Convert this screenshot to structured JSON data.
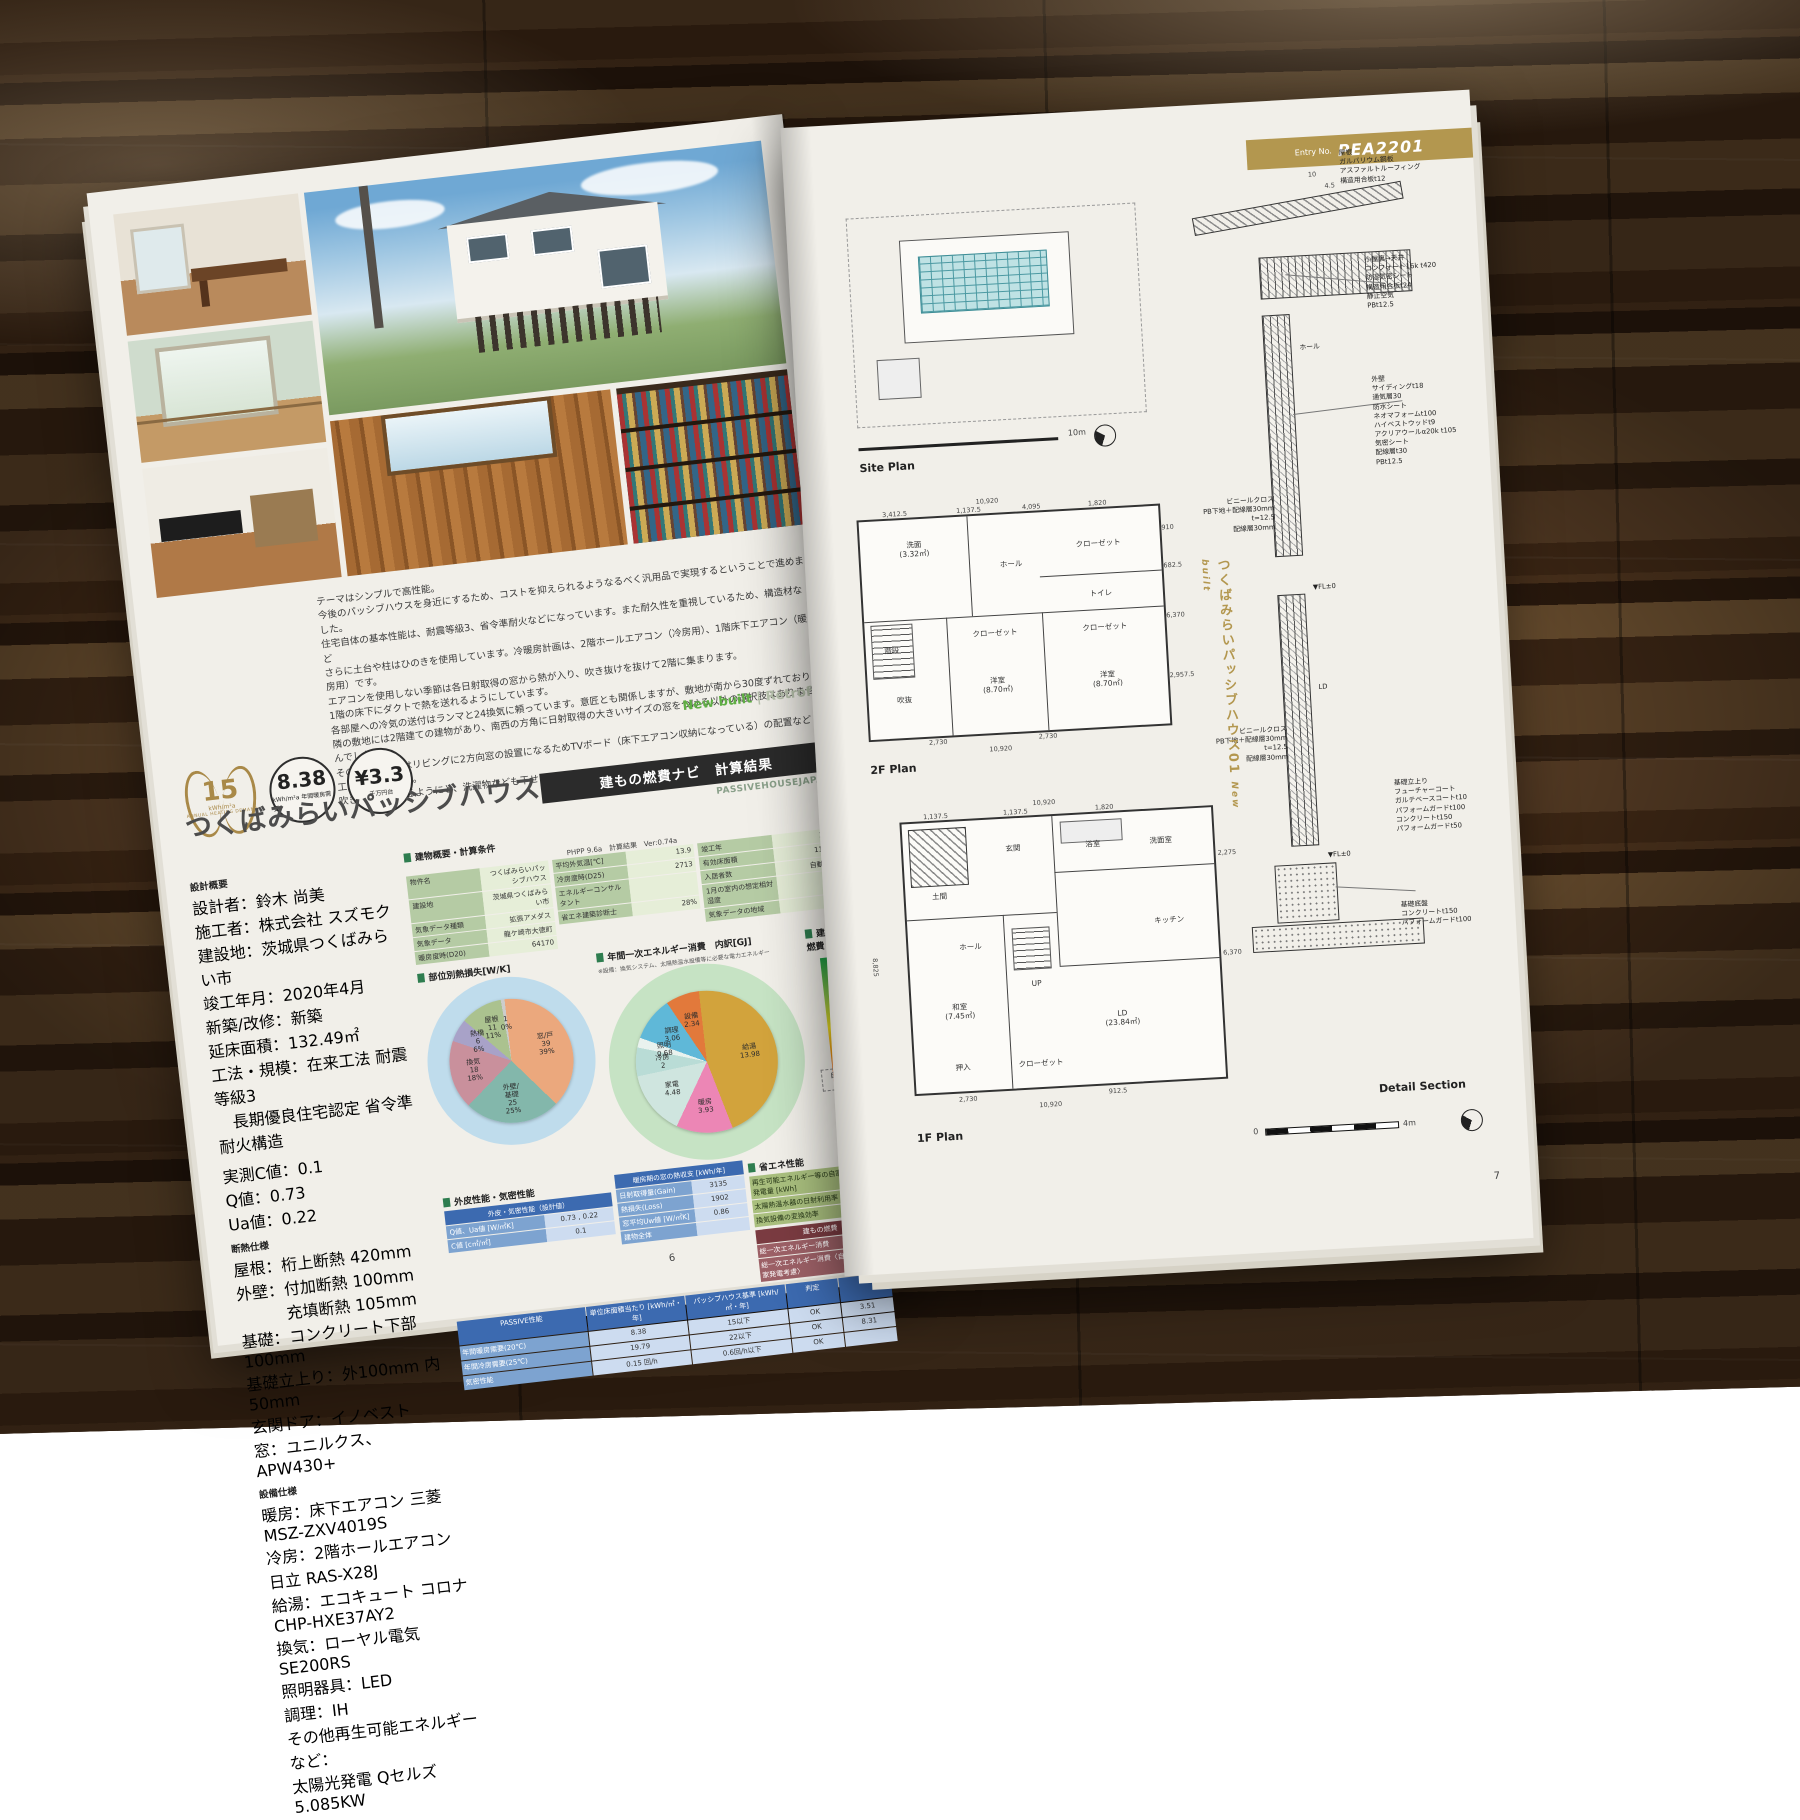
{
  "left_page": {
    "intro": "テーマはシンプルで高性能。\n今後のパッシブハウスを身近にするため、コストを抑えられるようなるべく汎用品で実現するということで進めました。\n住宅自体の基本性能は、耐震等級3、省令準耐火などになっています。また耐久性を重視しているため、構造材など\nさらに土台や柱はひのきを使用しています。冷暖房計画は、2階ホールエアコン（冷房用）、1階床下エアコン（暖房用）です。\nエアコンを使用しない季節は各日射取得の窓から熱が入り、吹き抜けを抜けて2階に集まります。\n1階の床下にダクトで熱を送れるようにしています。\n各部屋への冷気の送付はランマと24換気に頼っています。意匠とも関係しますが、敷地が南から30度ずれており\n隣の敷地には2階建ての建物があり、南西の方角に日射取得の大きいサイズの窓をつける以外の選択肢はありませんでした。\nそのため室内ではリビングに2方向窓の設置になるためTVボード（床下エアコン収納になっている）の配置など\n工夫をしています。\n吹き抜けは歩けるようにと、洗濯物なども干せるようになっています。",
    "badges": {
      "laurel": {
        "value": "15",
        "unit": "kWh/m²a",
        "caption": "ANNUAL HEATING DEMAND"
      },
      "heating": {
        "value": "8.38",
        "unit": "kWh/m²a 年間暖房需要"
      },
      "cost": {
        "value": "¥3.3",
        "unit": "千万円台"
      }
    },
    "build_type": {
      "new": "New built",
      "sep": " | ",
      "retro": "Retrofit"
    },
    "title": "つくばみらいパッシブハウス01",
    "results_bar": "建もの燃費ナビ　計算結果",
    "brand": "PASSIVEHOUSEJAPAN",
    "design_overview": {
      "heading": "設計概要",
      "items": "設計者：鈴木 尚美\n施工者：株式会社 スズモク\n建設地：茨城県つくばみらい市\n竣工年月：2020年4月\n新築/改修：新築\n延床面積：132.49㎡\n工法・規模：在来工法 耐震等級3\n　長期優良住宅認定 省令準耐火構造",
      "measured": "実測C値：0.1\nQ値：0.73\nUa値：0.22"
    },
    "insulation": {
      "heading": "断熱仕様",
      "items": "屋根：桁上断熱 420mm\n外壁：付加断熱 100mm\n　　　充填断熱 105mm\n基礎：コンクリート下部 100mm\n基礎立上り：外100mm 内50mm\n玄関ドア：イノベスト\n窓：ユニルクス、APW430+"
    },
    "equipment": {
      "heading": "設備仕様",
      "items": "暖房：床下エアコン 三菱 MSZ-ZXV4019S\n冷房：2階ホールエアコン 日立 RAS-X28J\n給湯：エコキュート コロナ CHP-HXE37AY2\n換気：ローヤル電気 SE200RS\n照明器具：LED\n調理：IH\nその他再生可能エネルギーなど：\n太陽光発電 Qセルズ 5.085KW"
    },
    "calc_table": {
      "heading": "建物概要・計算条件",
      "meta": "PHPP 9.6a　計算結果　Ver:0.74a",
      "col1": [
        {
          "label": "物件名",
          "value": "つくばみらいパッシブハウス"
        },
        {
          "label": "建設地",
          "value": "茨城県つくばみらい市"
        },
        {
          "label": "気象データ種類",
          "value": "拡張アメダス"
        },
        {
          "label": "気象データ",
          "value": "龍ケ崎市大徳町"
        },
        {
          "label": "暖房度時(D20)",
          "value": "64170"
        }
      ],
      "col2": [
        {
          "label": "平均外気温[℃]",
          "value": "13.9"
        },
        {
          "label": "冷房度時(D25)",
          "value": "2713"
        }
      ],
      "col3": [
        {
          "label": "竣工年",
          "value": "2020"
        },
        {
          "label": "有効床面積",
          "value": "116.57"
        },
        {
          "label": "入居者数",
          "value": "自動(2.6)"
        },
        {
          "label": "1月の室内の想定相対湿度",
          "value": ""
        },
        {
          "label": "気象データの地域",
          "value": ""
        }
      ],
      "col4": [
        {
          "label": "エネルギーコンサルタント",
          "value": ""
        },
        {
          "label": "省エネ建築診断士",
          "value": "28%"
        }
      ]
    },
    "sections": {
      "heat_loss": "部位別熱損失[W/K]",
      "energy": "年間一次エネルギー消費　内訳[GJ]",
      "energy_note": "※設備：換気システム、太陽熱温水設備等に必要な電力エネルギー",
      "fuel": "建もの燃費",
      "envelope": "外皮性能・気密性能",
      "eco": "省エネ性能"
    },
    "envelope_table": {
      "header": "外皮・気密性能（設計値）",
      "rows": [
        {
          "label": "Q値、Ua値 [W/㎡K]",
          "value": "0.73 , 0.22"
        },
        {
          "label": "C値 [c㎡/㎡]",
          "value": "0.1"
        }
      ]
    },
    "window_table": {
      "header": "暖房期の窓の熱収支 [kWh/年]",
      "rows": [
        {
          "label": "日射取得量(Gain)",
          "value": "3135"
        },
        {
          "label": "熱損失(Loss)",
          "value": "1902"
        }
      ],
      "uw_header": "窓平均Uw値 [W/㎡K]",
      "uw_value": "0.86",
      "whole_label": "建物全体"
    },
    "eco_table": {
      "rows": [
        {
          "label": "再生可能エネルギー等の自家発電量 [kWh]",
          "value": "0"
        },
        {
          "label": "太陽熱温水器の日射利用率",
          "value": "71%"
        },
        {
          "label": "換気設備の変換効率",
          "value": ""
        }
      ]
    },
    "fuel_table": {
      "header": "建もの燃費",
      "rows": [
        {
          "label": "総一次エネルギー消費",
          "value": "72.63"
        },
        {
          "label": "総一次エネルギー消費〈自家発電考慮〉",
          "value": "-12.20"
        }
      ],
      "gauge_below": "自家発電"
    },
    "passive_table": {
      "headers": [
        "PASSIVE性能",
        "単位床面積当たり [kWh/㎡・年]",
        "パッシブハウス基準 [kWh/㎡・年]",
        "判定",
        ""
      ],
      "rows": [
        [
          "年間暖房需要(20℃)",
          "8.38",
          "15以下",
          "OK",
          "3.51"
        ],
        [
          "年間冷房需要(25℃)",
          "19.79",
          "22以下",
          "OK",
          "8.31"
        ],
        [
          "気密性能",
          "0.15 回/h",
          "0.6回/h以下",
          "OK",
          ""
        ]
      ]
    },
    "page_number": "6"
  },
  "right_page": {
    "entry_label": "Entry No.",
    "entry_no": "PEA2201",
    "site_plan_label": "Site Plan",
    "plan2f_label": "2F Plan",
    "plan1f_label": "1F Plan",
    "detail_label": "Detail Section",
    "scale_site": "10m",
    "scale_zero": "0",
    "scale_detail": "4m",
    "page_number": "7",
    "vertical_title": "つくばみらいパッシブハウス01",
    "vertical_sub": "New built",
    "plan2f": {
      "rooms": [
        "洗面\n(3.32㎡)",
        "吹抜",
        "ホール",
        "クローゼット",
        "トイレ",
        "洋室\n(8.70㎡)",
        "クローゼット",
        "洋室\n(8.70㎡)",
        "階段",
        "クローゼット"
      ],
      "dims": [
        "10,920",
        "3,412.5",
        "1,137.5",
        "4,095",
        "1,820",
        "910",
        "682.5",
        "6,370",
        "2,957.5",
        "2,730",
        "2,730",
        "3,640",
        "1,820",
        "10,920"
      ]
    },
    "plan1f": {
      "rooms": [
        "土間",
        "玄関",
        "ホール",
        "和室\n(7.45㎡)",
        "押入",
        "クローゼット",
        "洗面室",
        "浴室",
        "キッチン",
        "LD\n(23.84㎡)",
        "UP"
      ],
      "dims": [
        "10,920",
        "1,137.5",
        "1,137.5",
        "1,820",
        "2,275",
        "6,370",
        "8,825",
        "2,730",
        "912.5",
        "10,920"
      ]
    },
    "detail": {
      "roof": "屋根\nガルバリウム鋼板\nアスファルトルーフィング\n構造用合板t12",
      "roof_pitch": "10",
      "roof_pitch2": "4.5",
      "attic": "小屋裏→天井\nコンフォート16k t420\n防湿気密シート\n構造用合板t24\n静止空気\nPBt12.5",
      "wall": "外壁\nサイディングt18\n通気層30\n防水シート\nネオマフォームt100\nハイベストウッドt9\nアクリアウールα20k t105\n気密シート\n配線層t30\nPBt12.5",
      "int1": "ビニールクロス\nPB下地＋配線層30mm t=12.5\n配線層30mm",
      "int2": "ビニールクロス\nPB下地＋配線層30mm t=12.5\n配線層30mm",
      "hall": "ホール",
      "ld": "LD",
      "fl_mark": "▼FL±0",
      "found1": "基礎立上り\nフューチャーコート\nガルテベースコートt10\nパフォームガードt100\nコンクリートt150\nパフォームガードt50",
      "found2": "基礎底盤\nコンクリートt150\nパフォームガードt100"
    }
  },
  "chart_data": [
    {
      "type": "pie",
      "id": "heat-loss",
      "title": "部位別熱損失[W/K]",
      "ring_color": "#bfdcec",
      "slices": [
        {
          "label": "窓/戸",
          "value": 39,
          "pct": "39%",
          "color": "#eba87d"
        },
        {
          "label": "外壁/\n基礎",
          "value": 25,
          "pct": "25%",
          "color": "#83b7ab"
        },
        {
          "label": "換気",
          "value": 18,
          "pct": "18%",
          "color": "#c9909c"
        },
        {
          "label": "熱橋",
          "value": 6,
          "pct": "6%",
          "color": "#a8a2c8"
        },
        {
          "label": "屋根",
          "value": 11,
          "pct": "11%",
          "color": "#abc28f"
        },
        {
          "label": "",
          "value": 1,
          "pct": "0%",
          "color": "#cccccc"
        }
      ]
    },
    {
      "type": "pie",
      "id": "primary-energy",
      "title": "年間一次エネルギー消費 内訳[GJ]",
      "ring_color": "#c6e3c4",
      "slices": [
        {
          "label": "給湯",
          "value": 13.98,
          "pct": "",
          "color": "#d2a33c"
        },
        {
          "label": "暖房",
          "value": 3.93,
          "pct": "",
          "color": "#ec86b5"
        },
        {
          "label": "家電",
          "value": 4.48,
          "pct": "",
          "color": "#cfe5df"
        },
        {
          "label": "冷房",
          "value": 2.0,
          "pct": "",
          "color": "#b9dcd6"
        },
        {
          "label": "照明",
          "value": 0.68,
          "pct": "",
          "color": "#e9f2ee"
        },
        {
          "label": "調理",
          "value": 3.06,
          "pct": "",
          "color": "#5fb8d8"
        },
        {
          "label": "設備",
          "value": 2.34,
          "pct": "",
          "color": "#e2793b"
        }
      ]
    },
    {
      "type": "gauge",
      "id": "fuel-gauge",
      "title": "建もの燃費",
      "value": "72.63",
      "with_pv": "-12.20"
    }
  ]
}
